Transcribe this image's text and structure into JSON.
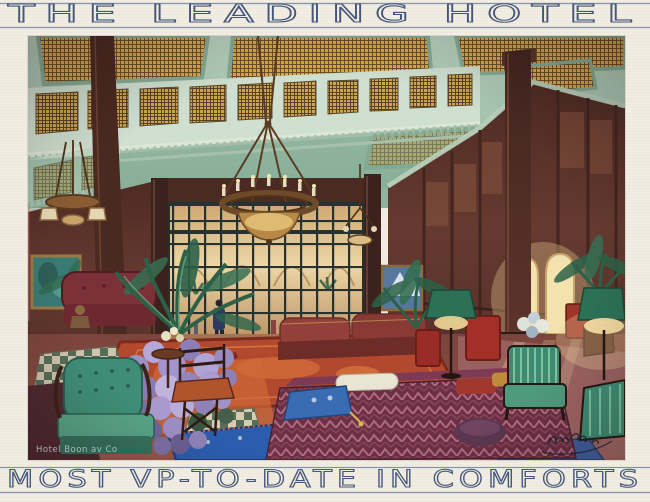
{
  "card": {
    "background_color": "#f1ede3",
    "rule_color": "#8494ab",
    "lettering_color": "#44567a",
    "header": {
      "title": "THE LEADING HOTEL"
    },
    "footer": {
      "title": "MOST VP-TO-DATE IN COMFORTS"
    },
    "artwork": {
      "medium": "watercolour interior illustration",
      "subject": "Grand hotel palm-court lounge with amber stained-glass skylight ceiling, leaded clerestory gallery, bronze chandeliers, tall glazed screen with doorman, dark panelled walls, palms, lilac hydrangeas, oriental carpets, green armchairs, kilim ottoman and green-shaded floor lamps",
      "caption_overlay": "Hotel Boon av Co",
      "signature_note": "illegible cursive artist signature, lower right",
      "palette": {
        "ceiling_celadon": "#a9c9b6",
        "stained_glass_amber": "#d9a851",
        "panelling_maroon": "#5f372e",
        "window_glow": "#e9d3a0",
        "carpet_red": "#b2492e",
        "rug_cobalt": "#2b5cad",
        "upholstery_green": "#3e8a72",
        "hydrangea_lilac": "#a193c6"
      }
    }
  }
}
